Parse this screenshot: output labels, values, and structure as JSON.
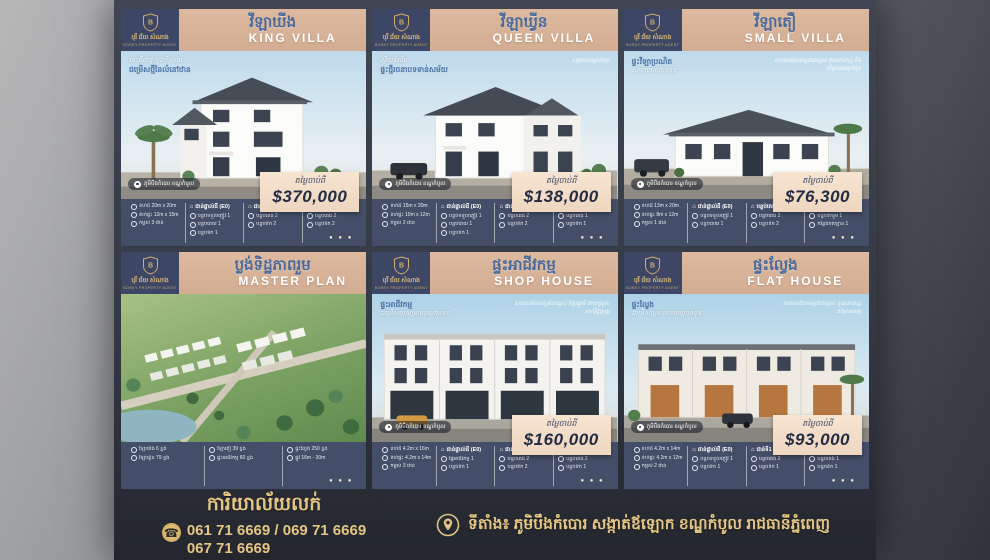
{
  "brand": {
    "logo_khmer": "បុរី ជ័យ សំណាង",
    "logo_sub": "BOREY PROPERTY AGENT"
  },
  "price_label": "តម្លៃចាប់ពី",
  "dots": "● ● ●",
  "pin_label": "ភូមិបឹងកំបោរ ខណ្ឌកំបូល",
  "cards": [
    {
      "title_km": "វីឡាឃីង",
      "title_en": "KING VILLA",
      "price": "$370,000",
      "caption_a": "នេះគឺជាផ្ទះក្នុងក្តីស្រមៃ",
      "caption_b": "ជម្រើសថ្មីនៃលំនៅឋាន",
      "caption_r": "",
      "spec_cols": [
        {
          "header": "",
          "items": [
            "ទំហំដី 20m x 20m",
            "ទំហំផ្ទះ 12m x 15m",
            "កម្ពស់ 3 ជាន់"
          ]
        },
        {
          "header": "ជាន់ផ្ទាល់ដី (E0)",
          "items": [
            "បន្ទប់ទទួលភ្ញៀវ 1",
            "បន្ទប់បាយ 1",
            "បន្ទប់ទឹក 1"
          ]
        },
        {
          "header": "ជាន់ទី1 (E1)",
          "items": [
            "បន្ទប់គេង 2",
            "បន្ទប់ទឹក 2"
          ]
        },
        {
          "header": "ជាន់ទី2 (E2)",
          "items": [
            "បន្ទប់គេង 2",
            "បន្ទប់ទឹក 2"
          ]
        }
      ]
    },
    {
      "title_km": "វីឡាឃ្វីន",
      "title_en": "QUEEN VILLA",
      "price": "$138,000",
      "caption_a": "ស្ទីលទំនើប",
      "caption_b": "ផ្ទះថ្មីរចនាបទទាន់សម័យ",
      "caption_r": "សម្រាប់បណ្តាក់ទុន",
      "spec_cols": [
        {
          "header": "",
          "items": [
            "ទំហំដី 15m x 20m",
            "ទំហំផ្ទះ 10m x 12m",
            "កម្ពស់ 2 ជាន់"
          ]
        },
        {
          "header": "ជាន់ផ្ទាល់ដី (E0)",
          "items": [
            "បន្ទប់ទទួលភ្ញៀវ 1",
            "បន្ទប់បាយ 1",
            "បន្ទប់ទឹក 1"
          ]
        },
        {
          "header": "ជាន់ទី1 (E1)",
          "items": [
            "បន្ទប់គេង 2",
            "បន្ទប់ទឹក 2"
          ]
        },
        {
          "header": "ជាន់ទី2 (E2)",
          "items": [
            "បន្ទប់គេង 1",
            "បន្ទប់ទឹក 1"
          ]
        }
      ]
    },
    {
      "title_km": "វីឡាតឿ",
      "title_en": "SMALL VILLA",
      "price": "$76,300",
      "caption_a": "ផ្ទះវីឡាប្រណិត",
      "caption_b": "សម្រាប់បណ្តាក់ទុន",
      "caption_r": "សាងសង់តាមស្តង់ដារខ្ពស់ គុណភាពល្អ និងតម្លៃសមរម្យបំផុត",
      "spec_cols": [
        {
          "header": "",
          "items": [
            "ទំហំដី 13m x 20m",
            "ទំហំផ្ទះ 8m x 12m",
            "កម្ពស់ 1 ជាន់"
          ]
        },
        {
          "header": "ជាន់ផ្ទាល់ដី (E0)",
          "items": [
            "បន្ទប់ទទួលភ្ញៀវ 1",
            "បន្ទប់បាយ 1"
          ]
        },
        {
          "header": "បន្ទប់គេង",
          "items": [
            "បន្ទប់គេង 2",
            "បន្ទប់ទឹក 2"
          ]
        },
        {
          "header": "បន្ទប់ផ្សេងៗ",
          "items": [
            "បន្ទប់ទឹករួម 1",
            "កន្លែងចតឡាន 1"
          ]
        }
      ]
    },
    {
      "title_km": "ប្លង់ទិដ្ឋភាពរួម",
      "title_en": "MASTER PLAN",
      "price": "",
      "caption_a": "",
      "caption_b": "",
      "caption_r": "",
      "spec_cols": [
        {
          "header": "",
          "items": [
            "វីឡាឃីង 6 ខ្នង",
            "វីឡាឃ្វីន 79 ខ្នង"
          ]
        },
        {
          "header": "",
          "items": [
            "វីឡាតឿ 39 ខ្នង",
            "ផ្ទះអាជីវកម្ម 60 ខ្នង"
          ]
        },
        {
          "header": "",
          "items": [
            "ផ្ទះល្វែង 250 ខ្នង",
            "ផ្លូវ 16m - 30m"
          ]
        }
      ]
    },
    {
      "title_km": "ផ្ទះអាជីវកម្ម",
      "title_en": "SHOP HOUSE",
      "price": "$160,000",
      "caption_a": "ផ្ទះអាជីវកម្ម",
      "caption_b": "ជម្រើសល្អសម្រាប់បណ្តាក់ទុន",
      "caption_r": "សាងសង់តាមស្តង់ដារខ្ពស់ ក្បែរផ្លូវធំ ងាយស្រួលរកស៊ីជួញដូរ",
      "spec_cols": [
        {
          "header": "",
          "items": [
            "ទំហំដី 4.2m x 16m",
            "ទំហំផ្ទះ 4.2m x 14m",
            "កម្ពស់ 3 ជាន់"
          ]
        },
        {
          "header": "ជាន់ផ្ទាល់ដី (E0)",
          "items": [
            "ផ្ទៃអាជីវកម្ម 1",
            "បន្ទប់ទឹក 1"
          ]
        },
        {
          "header": "ជាន់ទី1 (E1)",
          "items": [
            "បន្ទប់គេង 2",
            "បន្ទប់ទឹក 2"
          ]
        },
        {
          "header": "ជាន់ទី2 (E2)",
          "items": [
            "បន្ទប់គេង 2",
            "បន្ទប់ទឹក 1"
          ]
        }
      ]
    },
    {
      "title_km": "ផ្ទះល្វែង",
      "title_en": "FLAT HOUSE",
      "price": "$93,000",
      "caption_a": "ផ្ទះល្វែង",
      "caption_b": "ជម្រើសល្អសម្រាប់បណ្តាក់ទុន",
      "caption_r": "សាងសង់តាមស្តង់ដារខ្ពស់ គុណភាពល្អ តម្លៃសមរម្យ",
      "spec_cols": [
        {
          "header": "",
          "items": [
            "ទំហំដី 4.2m x 14m",
            "ទំហំផ្ទះ 4.2m x 12m",
            "កម្ពស់ 2 ជាន់"
          ]
        },
        {
          "header": "ជាន់ផ្ទាល់ដី (E0)",
          "items": [
            "បន្ទប់ទទួលភ្ញៀវ 1",
            "បន្ទប់ទឹក 1"
          ]
        },
        {
          "header": "ជាន់ទី1 (E1)",
          "items": [
            "បន្ទប់គេង 2",
            "បន្ទប់ទឹក 1"
          ]
        },
        {
          "header": "ជាន់ទី2 (E2)",
          "items": [
            "បន្ទប់គេង 1",
            "បន្ទប់ទឹក 1"
          ]
        }
      ]
    }
  ],
  "footer": {
    "office_title": "ការិយាល័យលក់",
    "phones_line1": "061 71 6669 / 069 71 6669",
    "phones_line2": "067 71 6669",
    "address": "ទីតាំង៖ ភូមិបឹងកំបោរ សង្កាត់ឪឡោក ខណ្ឌកំបូល រាជធានីភ្នំពេញ"
  },
  "colors": {
    "gold": "#e5c584",
    "tan": "#d9b49b",
    "navy": "#3d4765",
    "strip": "#454e68",
    "price_text": "#222d44"
  }
}
